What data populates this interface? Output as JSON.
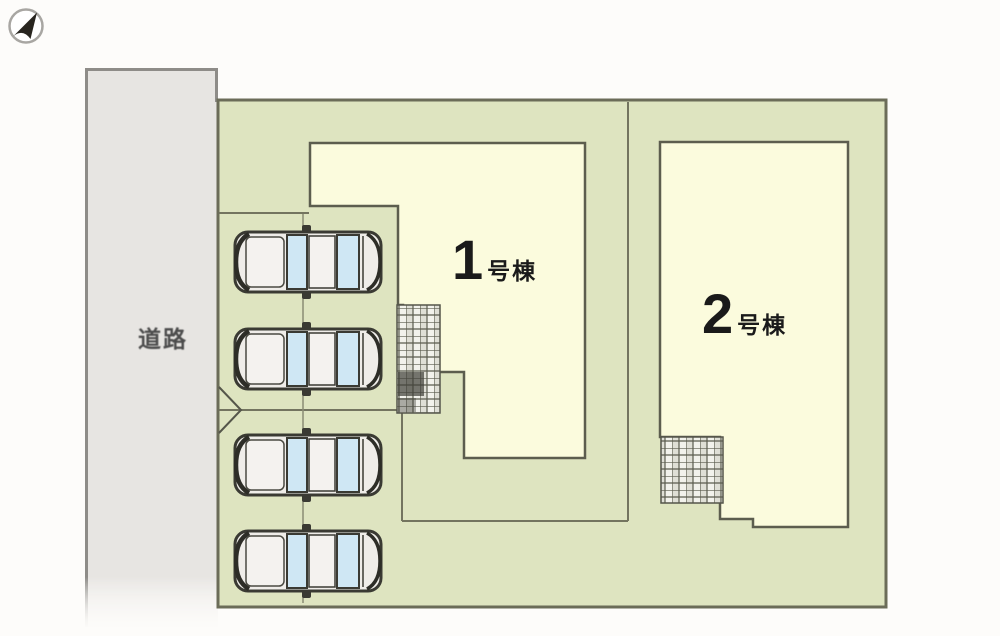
{
  "colors": {
    "background": "#fdfcfa",
    "road_gray": "#e7e5e2",
    "site_green": "#dee4c0",
    "building_cream": "#fbfbdd",
    "outline_olive": "#6b6c58",
    "car_body": "#efede9",
    "car_window_blue": "#cfe7f4",
    "label_black": "#1a1a1a"
  },
  "plan": {
    "road": {
      "label": "道路"
    },
    "buildings": [
      {
        "id": "1",
        "number": "1",
        "suffix": "号棟"
      },
      {
        "id": "2",
        "number": "2",
        "suffix": "号棟"
      }
    ],
    "parking": {
      "car_count": 4
    },
    "compass": {
      "icon": "north-arrow"
    }
  }
}
